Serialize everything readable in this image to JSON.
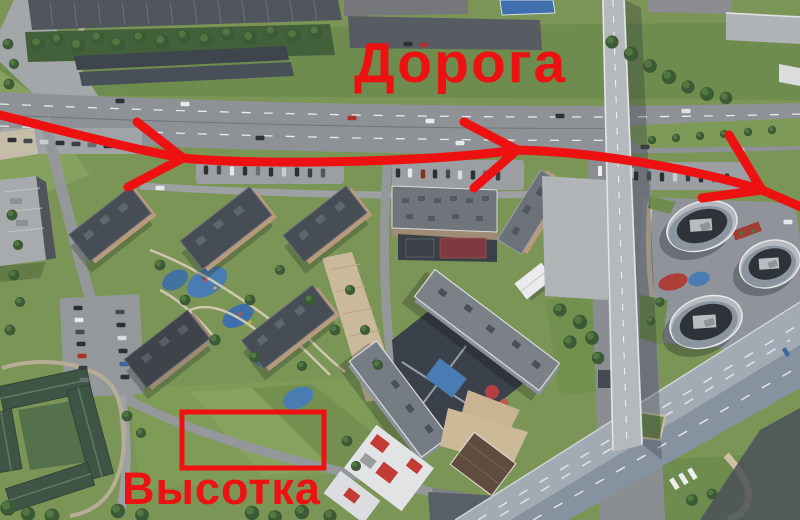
{
  "annotations": {
    "accent_color": "#ee1111",
    "road_label": "Дорога",
    "highrise_label": "Высотка",
    "arrow": {
      "shaft_d": "M -8 113 C 60 130, 130 149, 183 158 C 260 166, 430 162, 517 150 C 600 152, 702 171, 762 190 L 801 207",
      "head1_d": "M 137 122 L 183 158 L 128 187",
      "head2_d": "M 464 122 L 517 150 L 474 188",
      "head3_d": "M 729 135 L 762 190 L 702 198"
    },
    "highlight_rect": {
      "x": 182,
      "y": 412,
      "width": 142,
      "height": 56
    }
  }
}
